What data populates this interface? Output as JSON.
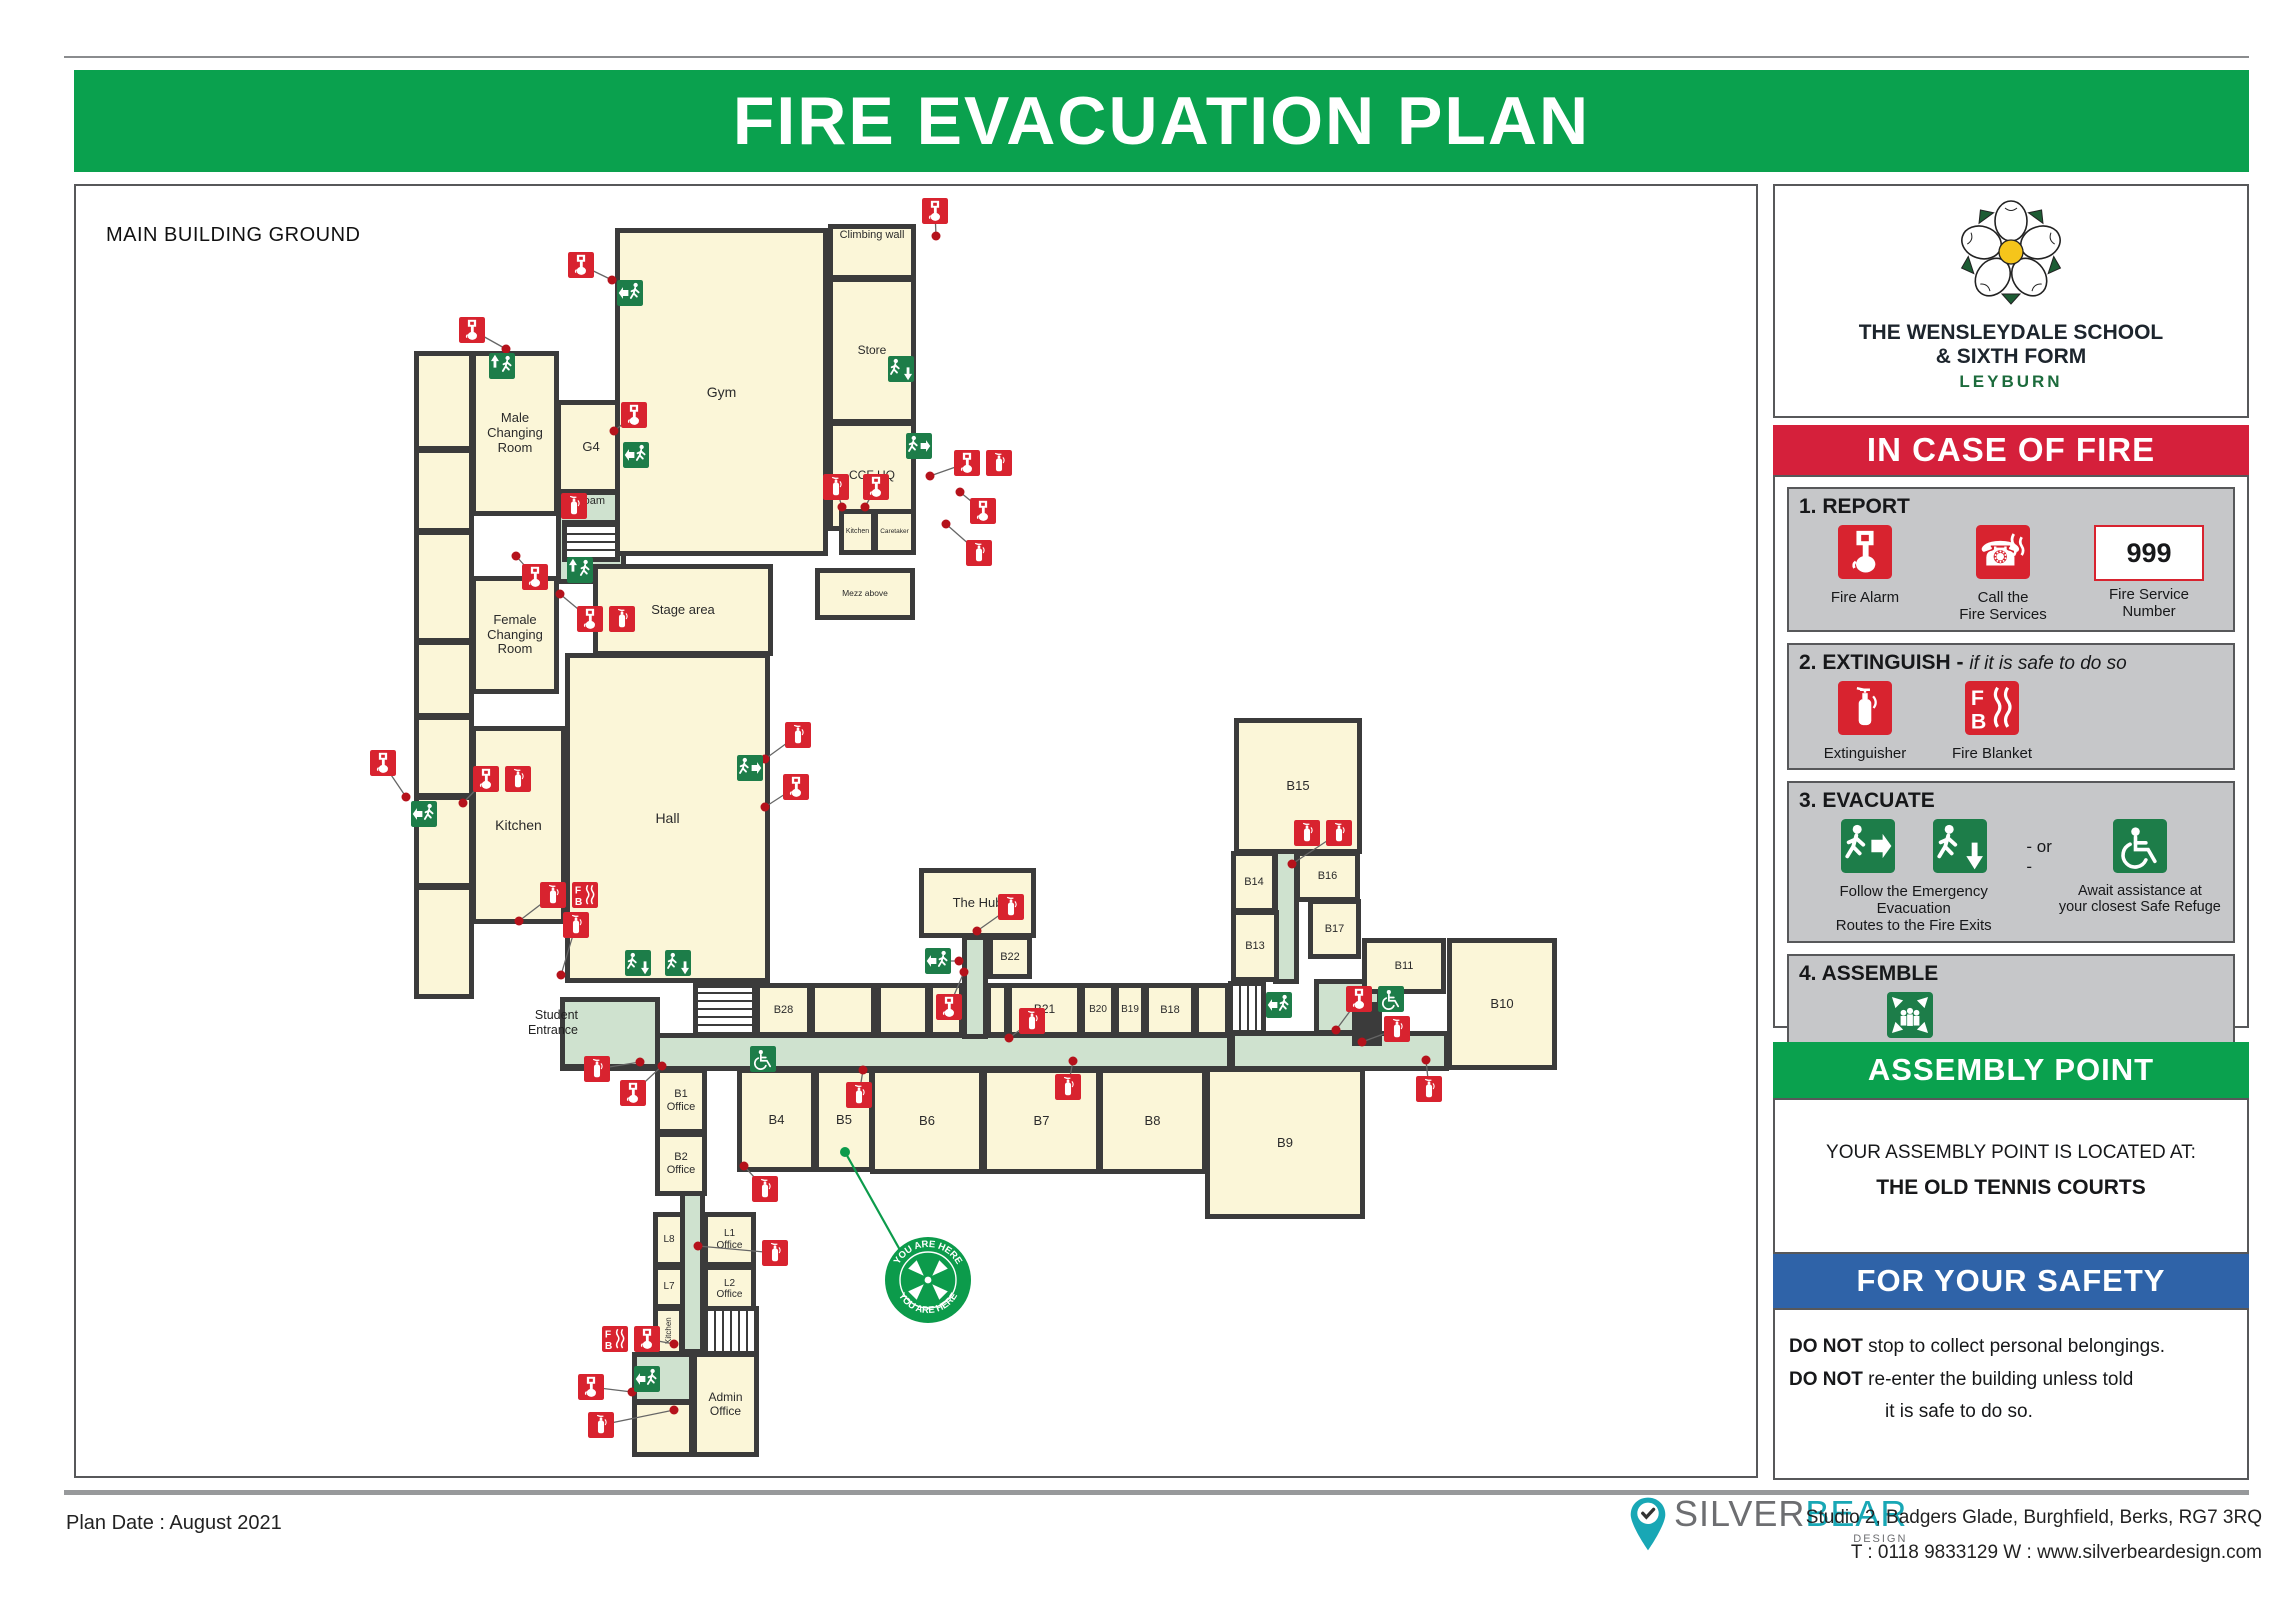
{
  "title": "FIRE EVACUATION PLAN",
  "colors": {
    "banner_green": "#0aa14e",
    "banner_red": "#d5203b",
    "banner_blue": "#2f63a8",
    "sign_green": "#1d7d49",
    "icon_red": "#d8232f",
    "wall": "#3b3b3b",
    "room_fill": "#fbf6d8",
    "corridor_fill": "#cfe2cf",
    "yah_green": "#0c9b4b",
    "brand_teal": "#18a7b5",
    "leyburn_green": "#1c6b3c"
  },
  "plan": {
    "heading": "MAIN BUILDING GROUND",
    "entrance_label": "Student\nEntrance",
    "you_are_here": {
      "label": "YOU ARE HERE",
      "cx": 852,
      "cy": 1094,
      "r": 44,
      "line": [
        769,
        966,
        824,
        1064
      ]
    },
    "rooms": [
      {
        "n": "corridor-foam",
        "label": "Foam",
        "x": 480,
        "y": 304,
        "w": 70,
        "h": 94,
        "type": "corr",
        "lp": "top",
        "fs": 11
      },
      {
        "n": "corridor-main",
        "x": 484,
        "y": 847,
        "w": 672,
        "h": 38,
        "type": "corr"
      },
      {
        "n": "student-entrance-lobby",
        "x": 484,
        "y": 811,
        "w": 100,
        "h": 72,
        "type": "corr"
      },
      {
        "n": "corridor-hub",
        "x": 886,
        "y": 749,
        "w": 26,
        "h": 104,
        "type": "corr"
      },
      {
        "n": "corridor-east",
        "x": 1154,
        "y": 845,
        "w": 219,
        "h": 40,
        "type": "corr"
      },
      {
        "n": "refuge-area",
        "x": 1238,
        "y": 793,
        "w": 68,
        "h": 56,
        "type": "corr"
      },
      {
        "n": "corridor-b15",
        "x": 1197,
        "y": 532,
        "w": 26,
        "h": 266,
        "type": "corr"
      },
      {
        "n": "corridor-south",
        "x": 604,
        "y": 883,
        "w": 25,
        "h": 285,
        "type": "corr"
      },
      {
        "n": "exit-lobby-south",
        "x": 556,
        "y": 1166,
        "w": 62,
        "h": 52,
        "type": "corr"
      },
      {
        "n": "left-column-1",
        "x": 338,
        "y": 165,
        "w": 60,
        "h": 100
      },
      {
        "n": "left-column-2",
        "x": 338,
        "y": 262,
        "w": 60,
        "h": 85
      },
      {
        "n": "left-column-3",
        "x": 338,
        "y": 344,
        "w": 60,
        "h": 113
      },
      {
        "n": "left-column-4",
        "x": 338,
        "y": 454,
        "w": 60,
        "h": 78
      },
      {
        "n": "left-column-5",
        "x": 338,
        "y": 529,
        "w": 60,
        "h": 83
      },
      {
        "n": "left-column-6",
        "x": 338,
        "y": 609,
        "w": 60,
        "h": 93
      },
      {
        "n": "left-column-7",
        "x": 338,
        "y": 699,
        "w": 60,
        "h": 114
      },
      {
        "n": "male-changing-room",
        "label": "Male\nChanging\nRoom",
        "x": 395,
        "y": 165,
        "w": 88,
        "h": 165,
        "fs": 13
      },
      {
        "n": "g4",
        "label": "G4",
        "x": 480,
        "y": 214,
        "w": 70,
        "h": 94,
        "fs": 13
      },
      {
        "n": "gym",
        "label": "Gym",
        "x": 539,
        "y": 42,
        "w": 213,
        "h": 328,
        "fs": 14
      },
      {
        "n": "climbing-wall",
        "label": "Climbing wall",
        "x": 752,
        "y": 38,
        "w": 88,
        "h": 56,
        "fs": 11,
        "lp": "top"
      },
      {
        "n": "store",
        "label": "Store",
        "x": 752,
        "y": 91,
        "w": 88,
        "h": 147,
        "fs": 12
      },
      {
        "n": "ccf-hq",
        "label": "CCF HQ",
        "x": 752,
        "y": 235,
        "w": 88,
        "h": 110,
        "fs": 12
      },
      {
        "n": "kitchen-small",
        "label": "Kitchen",
        "x": 763,
        "y": 323,
        "w": 37,
        "h": 46,
        "fs": 7
      },
      {
        "n": "caretaker",
        "label": "Caretaker",
        "x": 797,
        "y": 323,
        "w": 43,
        "h": 46,
        "fs": 6.5
      },
      {
        "n": "mezz-above",
        "label": "Mezz above",
        "x": 739,
        "y": 382,
        "w": 100,
        "h": 52,
        "fs": 8.5
      },
      {
        "n": "female-changing-room",
        "label": "Female\nChanging\nRoom",
        "x": 395,
        "y": 390,
        "w": 88,
        "h": 118,
        "fs": 13
      },
      {
        "n": "stage-area",
        "label": "Stage area",
        "x": 517,
        "y": 378,
        "w": 180,
        "h": 92,
        "fs": 13
      },
      {
        "n": "hall",
        "label": "Hall",
        "x": 489,
        "y": 467,
        "w": 205,
        "h": 330,
        "fs": 14
      },
      {
        "n": "kitchen",
        "label": "Kitchen",
        "x": 395,
        "y": 540,
        "w": 95,
        "h": 198,
        "fs": 14
      },
      {
        "n": "the-hub",
        "label": "The Hub",
        "x": 843,
        "y": 682,
        "w": 117,
        "h": 70,
        "fs": 13
      },
      {
        "n": "b22",
        "label": "B22",
        "x": 912,
        "y": 749,
        "w": 44,
        "h": 44,
        "fs": 11
      },
      {
        "n": "b15",
        "label": "B15",
        "x": 1158,
        "y": 532,
        "w": 128,
        "h": 136,
        "fs": 13
      },
      {
        "n": "b14",
        "label": "B14",
        "x": 1155,
        "y": 665,
        "w": 46,
        "h": 62,
        "fs": 11
      },
      {
        "n": "b16",
        "label": "B16",
        "x": 1219,
        "y": 665,
        "w": 65,
        "h": 51,
        "fs": 11
      },
      {
        "n": "b17",
        "label": "B17",
        "x": 1232,
        "y": 713,
        "w": 53,
        "h": 60,
        "fs": 11
      },
      {
        "n": "b13",
        "label": "B13",
        "x": 1155,
        "y": 724,
        "w": 48,
        "h": 72,
        "fs": 11
      },
      {
        "n": "b11",
        "label": "B11",
        "x": 1286,
        "y": 752,
        "w": 84,
        "h": 56,
        "fs": 11
      },
      {
        "n": "b10",
        "label": "B10",
        "x": 1371,
        "y": 752,
        "w": 110,
        "h": 132,
        "fs": 13
      },
      {
        "n": "b9",
        "label": "B9",
        "x": 1129,
        "y": 881,
        "w": 160,
        "h": 152,
        "fs": 13
      },
      {
        "n": "stairs-b28",
        "x": 617,
        "y": 797,
        "w": 64,
        "h": 54,
        "type": "stairs",
        "dir": "v"
      },
      {
        "n": "b28",
        "label": "B28",
        "x": 679,
        "y": 797,
        "w": 57,
        "h": 54,
        "fs": 11
      },
      {
        "n": "room-1",
        "x": 734,
        "y": 797,
        "w": 66,
        "h": 54
      },
      {
        "n": "room-2",
        "x": 800,
        "y": 797,
        "w": 54,
        "h": 54
      },
      {
        "n": "room-3",
        "x": 852,
        "y": 797,
        "w": 36,
        "h": 54
      },
      {
        "n": "room-4",
        "x": 910,
        "y": 797,
        "w": 23,
        "h": 54
      },
      {
        "n": "b21",
        "label": "B21",
        "x": 931,
        "y": 797,
        "w": 75,
        "h": 54,
        "fs": 12
      },
      {
        "n": "b20",
        "label": "B20",
        "x": 1004,
        "y": 797,
        "w": 36,
        "h": 54,
        "fs": 10
      },
      {
        "n": "b19",
        "label": "B19",
        "x": 1038,
        "y": 797,
        "w": 32,
        "h": 54,
        "fs": 10
      },
      {
        "n": "b18",
        "label": "B18",
        "x": 1068,
        "y": 797,
        "w": 52,
        "h": 54,
        "fs": 11
      },
      {
        "n": "room-5",
        "x": 1118,
        "y": 797,
        "w": 36,
        "h": 54
      },
      {
        "n": "stairs-east",
        "x": 1152,
        "y": 795,
        "w": 38,
        "h": 54,
        "type": "stairs",
        "dir": "h"
      },
      {
        "n": "b1-office",
        "label": "B1\nOffice",
        "x": 579,
        "y": 882,
        "w": 52,
        "h": 66,
        "fs": 11
      },
      {
        "n": "b2-office",
        "label": "B2\nOffice",
        "x": 579,
        "y": 946,
        "w": 52,
        "h": 64,
        "fs": 11
      },
      {
        "n": "b4",
        "label": "B4",
        "x": 661,
        "y": 882,
        "w": 79,
        "h": 104,
        "fs": 13
      },
      {
        "n": "b5",
        "label": "B5",
        "x": 738,
        "y": 882,
        "w": 60,
        "h": 104,
        "fs": 13
      },
      {
        "n": "b6",
        "label": "B6",
        "x": 794,
        "y": 882,
        "w": 114,
        "h": 106,
        "fs": 13
      },
      {
        "n": "b7",
        "label": "B7",
        "x": 906,
        "y": 882,
        "w": 119,
        "h": 106,
        "fs": 13
      },
      {
        "n": "b8",
        "label": "B8",
        "x": 1022,
        "y": 882,
        "w": 109,
        "h": 106,
        "fs": 13
      },
      {
        "n": "l8",
        "label": "L8",
        "x": 577,
        "y": 1026,
        "w": 32,
        "h": 55,
        "fs": 10
      },
      {
        "n": "l1-office",
        "label": "L1\nOffice",
        "x": 627,
        "y": 1026,
        "w": 53,
        "h": 55,
        "fs": 10
      },
      {
        "n": "l7",
        "label": "L7",
        "x": 577,
        "y": 1079,
        "w": 32,
        "h": 44,
        "fs": 10
      },
      {
        "n": "l2-office",
        "label": "L2\nOffice",
        "x": 627,
        "y": 1079,
        "w": 53,
        "h": 48,
        "fs": 10
      },
      {
        "n": "kitchen-south",
        "label": "Kitchen",
        "x": 577,
        "y": 1120,
        "w": 31,
        "h": 50,
        "fs": 8,
        "vert": true
      },
      {
        "n": "stairs-south",
        "x": 627,
        "y": 1120,
        "w": 56,
        "h": 50,
        "type": "stairs",
        "dir": "h"
      },
      {
        "n": "stairs-foam",
        "x": 486,
        "y": 334,
        "w": 58,
        "h": 42,
        "type": "stairs",
        "dir": "v"
      },
      {
        "n": "admin-office",
        "label": "Admin\nOffice",
        "x": 616,
        "y": 1166,
        "w": 67,
        "h": 105,
        "fs": 12
      },
      {
        "n": "room-sw",
        "x": 556,
        "y": 1214,
        "w": 62,
        "h": 57
      },
      {
        "n": "lift",
        "x": 1276,
        "y": 816,
        "w": 30,
        "h": 44,
        "type": "dark"
      }
    ],
    "icons": [
      {
        "t": "alarm",
        "x": 846,
        "y": 12,
        "dot": [
          860,
          50
        ]
      },
      {
        "t": "alarm",
        "x": 492,
        "y": 66,
        "dot": [
          536,
          94
        ]
      },
      {
        "t": "exit-l",
        "x": 541,
        "y": 94
      },
      {
        "t": "alarm",
        "x": 383,
        "y": 131,
        "dot": [
          430,
          163
        ]
      },
      {
        "t": "exit-u",
        "x": 413,
        "y": 167
      },
      {
        "t": "exit-d",
        "x": 812,
        "y": 170
      },
      {
        "t": "exit-r",
        "x": 830,
        "y": 247
      },
      {
        "t": "alarm",
        "x": 878,
        "y": 264,
        "dot": [
          854,
          290
        ]
      },
      {
        "t": "ext",
        "x": 910,
        "y": 264
      },
      {
        "t": "ext",
        "x": 747,
        "y": 288,
        "dot": [
          766,
          321
        ]
      },
      {
        "t": "alarm",
        "x": 787,
        "y": 288,
        "dot": [
          789,
          321
        ]
      },
      {
        "t": "alarm",
        "x": 894,
        "y": 312,
        "dot": [
          884,
          306
        ]
      },
      {
        "t": "ext",
        "x": 890,
        "y": 354,
        "dot": [
          870,
          338
        ]
      },
      {
        "t": "ext",
        "x": 485,
        "y": 307
      },
      {
        "t": "alarm",
        "x": 545,
        "y": 216,
        "dot": [
          538,
          245
        ]
      },
      {
        "t": "exit-l",
        "x": 547,
        "y": 256
      },
      {
        "t": "alarm",
        "x": 446,
        "y": 378,
        "dot": [
          440,
          370
        ]
      },
      {
        "t": "exit-u",
        "x": 491,
        "y": 371
      },
      {
        "t": "alarm",
        "x": 501,
        "y": 420,
        "dot": [
          484,
          408
        ]
      },
      {
        "t": "ext",
        "x": 533,
        "y": 420
      },
      {
        "t": "alarm",
        "x": 294,
        "y": 564,
        "dot": [
          330,
          611
        ]
      },
      {
        "t": "exit-l",
        "x": 335,
        "y": 615
      },
      {
        "t": "alarm",
        "x": 397,
        "y": 580,
        "dot": [
          387,
          617
        ]
      },
      {
        "t": "ext",
        "x": 429,
        "y": 580
      },
      {
        "t": "ext",
        "x": 464,
        "y": 696,
        "dot": [
          443,
          735
        ]
      },
      {
        "t": "fb",
        "x": 496,
        "y": 696
      },
      {
        "t": "ext",
        "x": 487,
        "y": 726,
        "dot": [
          485,
          789
        ]
      },
      {
        "t": "ext",
        "x": 709,
        "y": 536,
        "dot": [
          689,
          573
        ]
      },
      {
        "t": "exit-r",
        "x": 661,
        "y": 569
      },
      {
        "t": "alarm",
        "x": 707,
        "y": 588,
        "dot": [
          689,
          621
        ]
      },
      {
        "t": "exit-d",
        "x": 549,
        "y": 764
      },
      {
        "t": "exit-d",
        "x": 589,
        "y": 764
      },
      {
        "t": "ext",
        "x": 922,
        "y": 708,
        "dot": [
          901,
          745
        ]
      },
      {
        "t": "exit-l",
        "x": 849,
        "y": 762,
        "dot": [
          883,
          775
        ]
      },
      {
        "t": "alarm",
        "x": 860,
        "y": 808,
        "dot": [
          888,
          786
        ]
      },
      {
        "t": "ext",
        "x": 943,
        "y": 822,
        "dot": [
          933,
          852
        ]
      },
      {
        "t": "ext",
        "x": 979,
        "y": 888,
        "dot": [
          997,
          875
        ]
      },
      {
        "t": "ext",
        "x": 770,
        "y": 896,
        "dot": [
          787,
          884
        ]
      },
      {
        "t": "ext",
        "x": 1218,
        "y": 634
      },
      {
        "t": "ext",
        "x": 1250,
        "y": 634,
        "dot": [
          1216,
          678
        ]
      },
      {
        "t": "exit-l",
        "x": 1190,
        "y": 806
      },
      {
        "t": "alarm",
        "x": 1270,
        "y": 800,
        "dot": [
          1260,
          844
        ]
      },
      {
        "t": "refuge",
        "x": 1302,
        "y": 800
      },
      {
        "t": "ext",
        "x": 1308,
        "y": 830,
        "dot": [
          1286,
          856
        ]
      },
      {
        "t": "ext",
        "x": 1340,
        "y": 890,
        "dot": [
          1350,
          874
        ]
      },
      {
        "t": "ext",
        "x": 508,
        "y": 870,
        "dot": [
          564,
          876
        ]
      },
      {
        "t": "alarm",
        "x": 544,
        "y": 894,
        "dot": [
          586,
          880
        ]
      },
      {
        "t": "refuge",
        "x": 674,
        "y": 860
      },
      {
        "t": "ext",
        "x": 676,
        "y": 990,
        "dot": [
          668,
          980
        ]
      },
      {
        "t": "ext",
        "x": 686,
        "y": 1054,
        "dot": [
          622,
          1060
        ]
      },
      {
        "t": "fb",
        "x": 526,
        "y": 1140
      },
      {
        "t": "alarm",
        "x": 558,
        "y": 1140,
        "dot": [
          598,
          1158
        ]
      },
      {
        "t": "exit-l",
        "x": 558,
        "y": 1180
      },
      {
        "t": "alarm",
        "x": 502,
        "y": 1188,
        "dot": [
          556,
          1206
        ]
      },
      {
        "t": "ext",
        "x": 512,
        "y": 1226,
        "dot": [
          598,
          1224
        ]
      }
    ]
  },
  "sidebar": {
    "school": {
      "line1": "THE WENSLEYDALE SCHOOL",
      "line2": "& SIXTH FORM",
      "line3": "LEYBURN"
    },
    "fire_banner": "IN CASE OF FIRE",
    "steps": [
      {
        "title": "1. REPORT",
        "items": [
          {
            "label": "Fire Alarm"
          },
          {
            "label": "Call the\nFire Services"
          },
          {
            "value": "999",
            "label": "Fire Service\nNumber"
          }
        ]
      },
      {
        "title": "2. EXTINGUISH - ",
        "subtitle": "if it is safe to do so",
        "items": [
          {
            "label": "Extinguisher"
          },
          {
            "label": "Fire Blanket"
          }
        ]
      },
      {
        "title": "3. EVACUATE",
        "or_text": "- or -",
        "caption_left": "Follow the Emergency Evacuation\nRoutes to the Fire Exits",
        "caption_right": "Await assistance at\nyour closest Safe Refuge"
      },
      {
        "title": "4. ASSEMBLE",
        "caption": "Proceed to your\nAssembly Point"
      }
    ],
    "assembly": {
      "banner": "ASSEMBLY POINT",
      "line1": "YOUR ASSEMBLY POINT IS LOCATED AT:",
      "line2": "THE OLD TENNIS COURTS"
    },
    "safety": {
      "banner": "FOR YOUR SAFETY",
      "do_not": "DO NOT",
      "line1": " stop to collect personal belongings.",
      "line2": " re-enter the building unless told",
      "line3": "it is safe to do so."
    }
  },
  "footer": {
    "plan_date": "Plan Date : August 2021",
    "brand": {
      "silver": "SILVER",
      "bear": "BEAR",
      "design": "DESIGN"
    },
    "address": "Studio 2, Badgers Glade, Burghfield, Berks, RG7 3RQ",
    "contact": "T : 0118 9833129   W : www.silverbeardesign.com"
  }
}
